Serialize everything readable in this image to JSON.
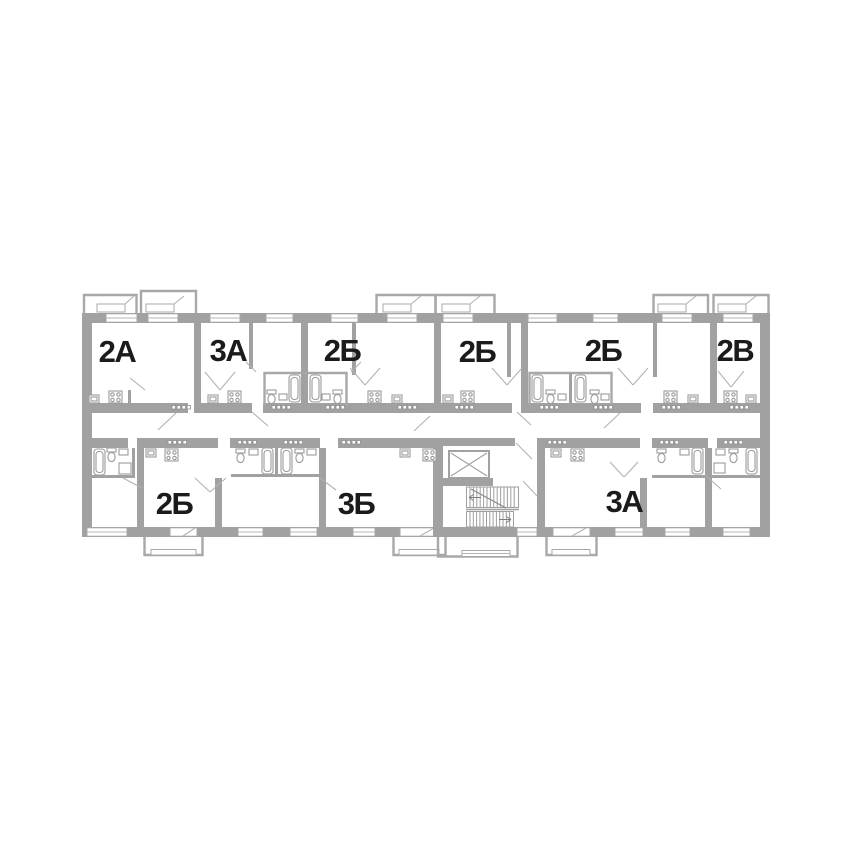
{
  "floor_plan": {
    "background": "#ffffff",
    "colors": {
      "wall": "#a1a1a1",
      "fixture_line": "#9b9b9b",
      "door_swing": "#b2b2b2",
      "label_text": "#1b1b1b"
    },
    "apartments": {
      "top": [
        {
          "label": "2А"
        },
        {
          "label": "3А"
        },
        {
          "label": "2Б"
        },
        {
          "label": "2Б"
        },
        {
          "label": "2Б"
        },
        {
          "label": "2В"
        }
      ],
      "bottom": [
        {
          "label": "2Б"
        },
        {
          "label": "3Б"
        },
        {
          "label": "3А"
        }
      ]
    },
    "features": {
      "elevator_icon": "rect-with-x",
      "staircase_icon": "hatched-steps-with-arrows",
      "bathroom_icons": [
        "bathtub-icon",
        "toilet-icon",
        "sink-icon"
      ],
      "kitchen_icons": [
        "stove-icon",
        "kitchen-sink-icon"
      ]
    }
  }
}
